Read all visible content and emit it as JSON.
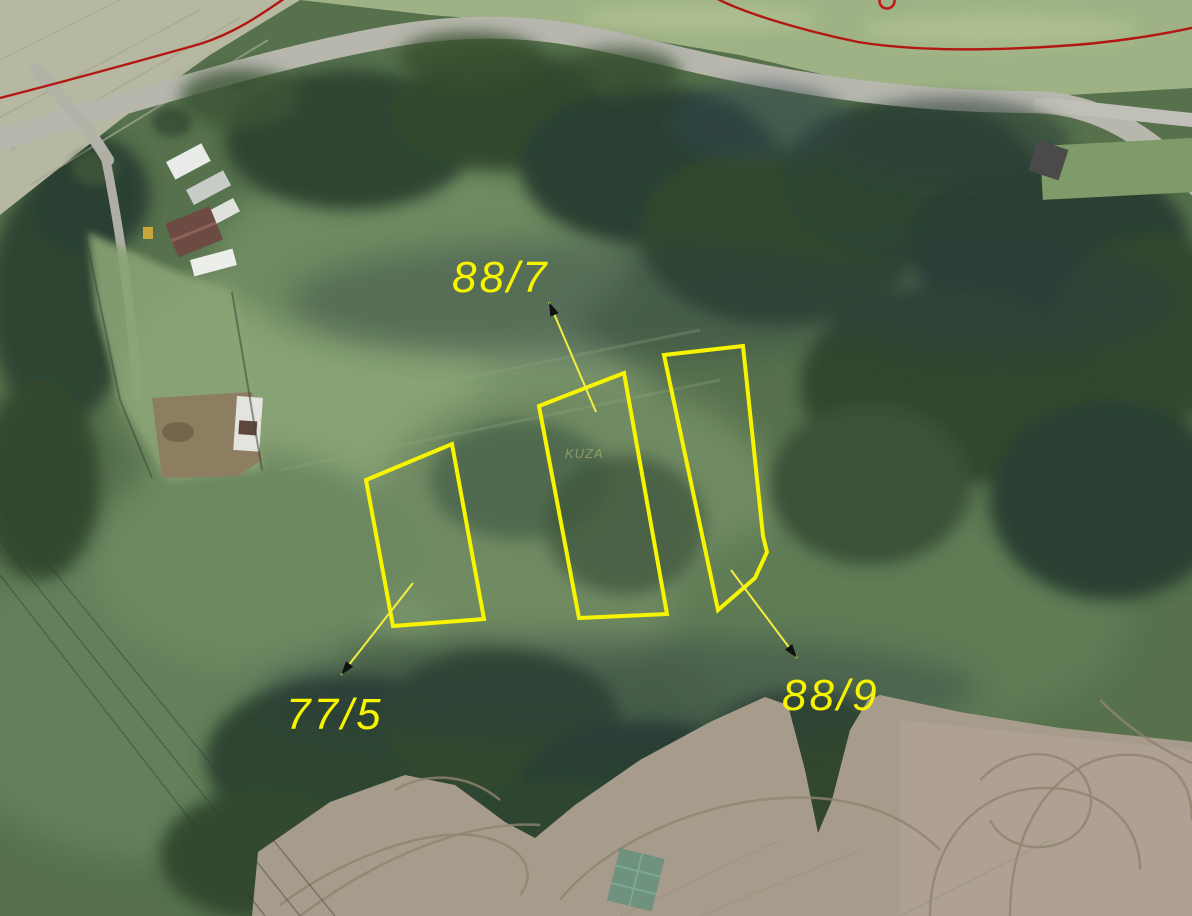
{
  "map": {
    "type": "aerial-cadastral",
    "overlay_color": "#f7f400",
    "boundary_color": "#b21712",
    "arrowhead_color": "#111111",
    "parcels": [
      {
        "id": "77/5",
        "polygon": [
          [
            366,
            480
          ],
          [
            452,
            444
          ],
          [
            484,
            619
          ],
          [
            393,
            626
          ]
        ],
        "label": {
          "text": "77/5",
          "x": 286,
          "y": 729
        },
        "arrow": {
          "x1": 413,
          "y1": 583,
          "x2": 341,
          "y2": 675
        }
      },
      {
        "id": "88/7",
        "polygon": [
          [
            539,
            406
          ],
          [
            624,
            373
          ],
          [
            667,
            614
          ],
          [
            579,
            618
          ]
        ],
        "label": {
          "text": "88/7",
          "x": 452,
          "y": 292
        },
        "arrow": {
          "x1": 596,
          "y1": 412,
          "x2": 549,
          "y2": 302
        }
      },
      {
        "id": "88/9",
        "polygon": [
          [
            664,
            355
          ],
          [
            743,
            346
          ],
          [
            763,
            536
          ],
          [
            767,
            552
          ],
          [
            755,
            578
          ],
          [
            718,
            610
          ]
        ],
        "label": {
          "text": "88/9",
          "x": 782,
          "y": 710
        },
        "arrow": {
          "x1": 731,
          "y1": 570,
          "x2": 797,
          "y2": 658
        }
      }
    ],
    "faint_text": {
      "text": "KUZA",
      "x": 565,
      "y": 458
    },
    "red_boundary": {
      "paths": [
        "M 0,98 C 70,80 150,58 200,44 C 235,33 262,14 288,-4",
        "M 712,-4 C 740,12 800,30 858,42 C 920,52 1000,50 1060,46 C 1110,43 1160,35 1196,27"
      ],
      "marker_circle": {
        "cx": 887,
        "cy": 1,
        "r": 7.5
      }
    }
  }
}
